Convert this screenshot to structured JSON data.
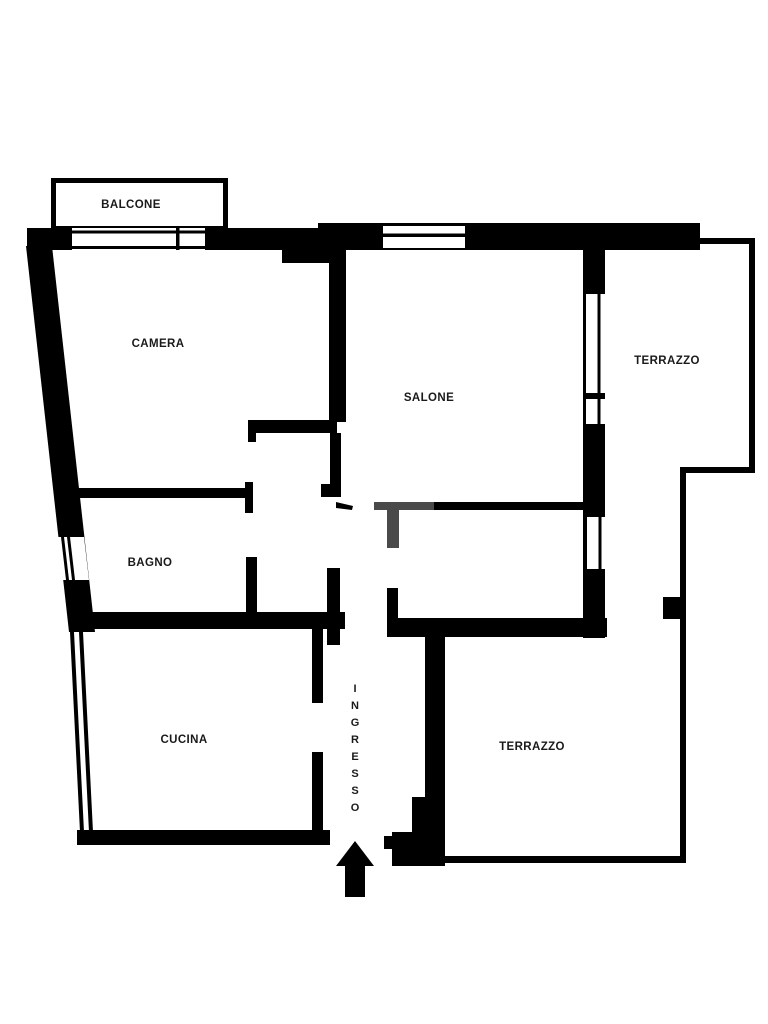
{
  "plan": {
    "type": "apartment-floor-plan",
    "colors": {
      "background": "#ffffff",
      "wall": "#000000",
      "door": "#4a4a4a",
      "label": "#1a1a1a"
    },
    "rooms": {
      "balcone": {
        "label": "BALCONE"
      },
      "camera": {
        "label": "CAMERA"
      },
      "salone": {
        "label": "SALONE"
      },
      "terrazzo_upper": {
        "label": "TERRAZZO"
      },
      "bagno": {
        "label": "BAGNO"
      },
      "cucina": {
        "label": "CUCINA"
      },
      "terrazzo_lower": {
        "label": "TERRAZZO"
      },
      "ingresso": {
        "label": "INGRESSO"
      }
    },
    "entrance": {
      "label": "INGRESSO",
      "arrow_direction": "up"
    }
  }
}
